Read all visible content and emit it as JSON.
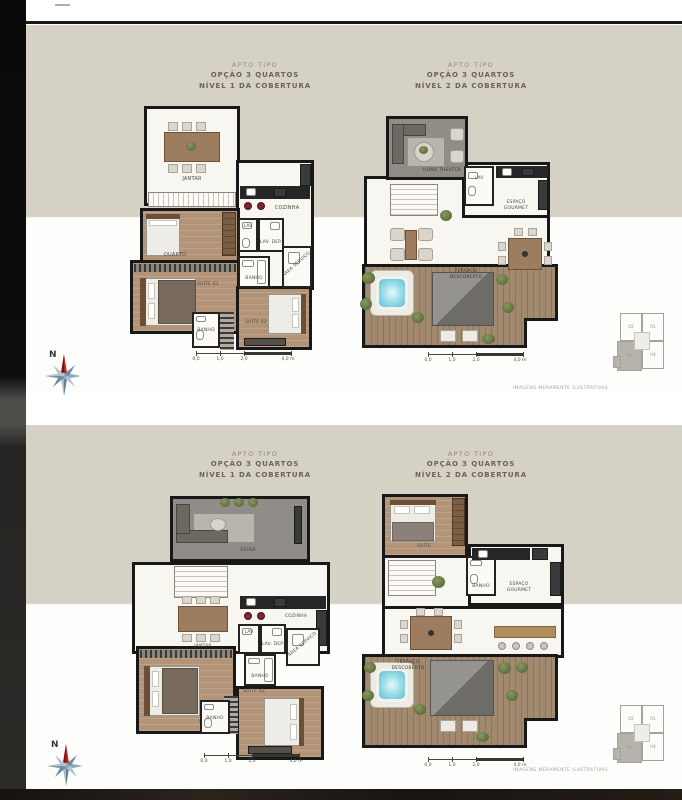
{
  "colors": {
    "panel_beige": "#d6d1c5",
    "wall": "#181818",
    "wood_floor": "#b49478",
    "terrace_deck": "#a28a70",
    "jacuzzi_water": "#7fcede",
    "stool_red": "#7c2531",
    "compass_north_red": "#b6281c"
  },
  "panels": [
    {
      "headers": [
        {
          "line1": "APTO TIPO",
          "line2": "OPÇÃO 3 QUARTOS",
          "line3": "NÍVEL 1 DA COBERTURA"
        },
        {
          "line1": "APTO TIPO",
          "line2": "OPÇÃO 3 QUARTOS",
          "line3": "NÍVEL 2 DA COBERTURA"
        }
      ],
      "disclaimer": "IMAGENS MERAMENTE ILUSTRATIVAS"
    },
    {
      "headers": [
        {
          "line1": "APTO TIPO",
          "line2": "OPÇÃO 3 QUARTOS",
          "line3": "NÍVEL 1 DA COBERTURA"
        },
        {
          "line1": "APTO TIPO",
          "line2": "OPÇÃO 3 QUARTOS",
          "line3": "NÍVEL 2 DA COBERTURA"
        }
      ],
      "disclaimer": "IMAGENS MERAMENTE ILUSTRATIVAS"
    }
  ],
  "compass": {
    "north_label": "N"
  },
  "scalebar": {
    "t0": "0,0",
    "t1": "1,0",
    "t2": "2,0",
    "t3": "4,0 m"
  },
  "keyplan": {
    "unit_top_left": "02",
    "unit_top_right": "01",
    "unit_bottom_left": "03",
    "unit_bottom_right": "04"
  },
  "plans": {
    "opt1_level1": {
      "rooms": {
        "jantar": "JANTAR",
        "cozinha": "COZINHA",
        "lav": "LAV",
        "lav_dep": "LAV. DEP.",
        "area_servico": "ÁREA SERVIÇO",
        "banho1": "BANHO",
        "quarto": "QUARTO",
        "suite01": "SUÍTE 01",
        "suite02": "SUÍTE 02",
        "banho2": "BANHO"
      }
    },
    "opt1_level2": {
      "rooms": {
        "home_theater": "HOME THEATER",
        "lav": "LAV",
        "espaco_gourmet": "ESPAÇO GOURMET",
        "terraco": "TERRAÇO DESCOBERTO"
      }
    },
    "opt2_level1": {
      "rooms": {
        "estar": "ESTAR",
        "jantar": "JANTAR",
        "cozinha": "COZINHA",
        "lav": "LAV",
        "lav_dep": "LAV. DEP.",
        "area_servico": "ÁREA SERVIÇO",
        "banho1": "BANHO",
        "suite01": "SUÍTE 01",
        "suite02": "SUÍTE 02",
        "banho2": "BANHO"
      }
    },
    "opt2_level2": {
      "rooms": {
        "suite": "SUÍTE",
        "banho": "BANHO",
        "espaco_gourmet": "ESPAÇO GOURMET",
        "terraco": "TERRAÇO DESCOBERTO"
      }
    }
  }
}
